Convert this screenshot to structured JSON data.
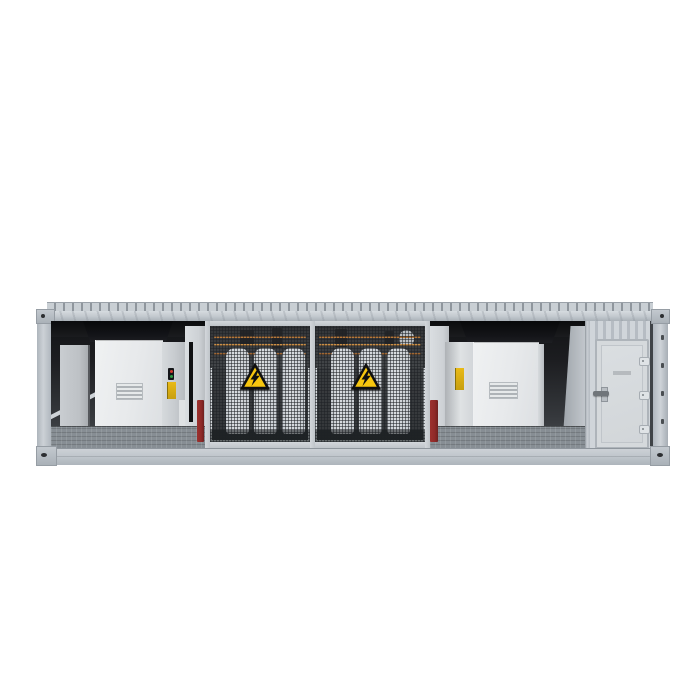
{
  "scene": {
    "background_color": "#ffffff",
    "subject": "containerized-transformer-substation-3d-render",
    "container_box": {
      "left": 37,
      "top": 302,
      "width": 631,
      "height": 162
    }
  },
  "palette": {
    "body_gray": "#c5cbd1",
    "rail_light": "#d6dbdf",
    "rail_dark": "#aab1b8",
    "interior_dark": "#141518",
    "cabinet_face": "#e9ebec",
    "cabinet_top_black": "#0c0d0f",
    "cage_frame": "#cfd4d8",
    "mesh_dark": "#303336",
    "radiator_fin": "#d8dce0",
    "warning_yellow": "#f7c60e",
    "warning_black": "#101010",
    "accent_red": "#8f2a28",
    "copper": "#b26f2e",
    "floor_checker": "#878e94"
  },
  "sections": [
    {
      "name": "left-corner-post"
    },
    {
      "name": "equipment-bay-left",
      "cabinet": {
        "vent_slats": 3,
        "indicator_lights": [
          "red",
          "green"
        ],
        "warning_sticker": true
      },
      "rear_cabinet": true,
      "red_bollard": true
    },
    {
      "name": "transformer-cage",
      "mesh_panels": 2,
      "fins_per_panel": 3,
      "warning_signs": 2
    },
    {
      "name": "equipment-bay-right",
      "cabinet": {
        "vent_slats": 3,
        "warning_sticker": true
      },
      "red_bollard": true
    },
    {
      "name": "access-door-panel",
      "door": {
        "hinges": 3,
        "handle_side": "left"
      }
    },
    {
      "name": "right-corner-post",
      "lock_marks": 5
    }
  ],
  "cage": {
    "fins_per_panel": 3,
    "fin_offsets": [
      16,
      44,
      72
    ],
    "busbar_lines": [
      {
        "top": 10,
        "color": "#b26f2e"
      },
      {
        "top": 18,
        "color": "#c9893c"
      },
      {
        "top": 27,
        "color": "#9c5f28"
      }
    ],
    "warning_sign": {
      "symbol": "high-voltage-lightning",
      "bg": "#f7c60e",
      "border": "#101010"
    }
  },
  "door": {
    "hinges": 3,
    "hinge_tops": [
      16,
      50,
      84
    ]
  },
  "right_post": {
    "lock_marks": 5,
    "mark_tops": [
      24,
      52,
      80,
      108,
      136
    ]
  }
}
